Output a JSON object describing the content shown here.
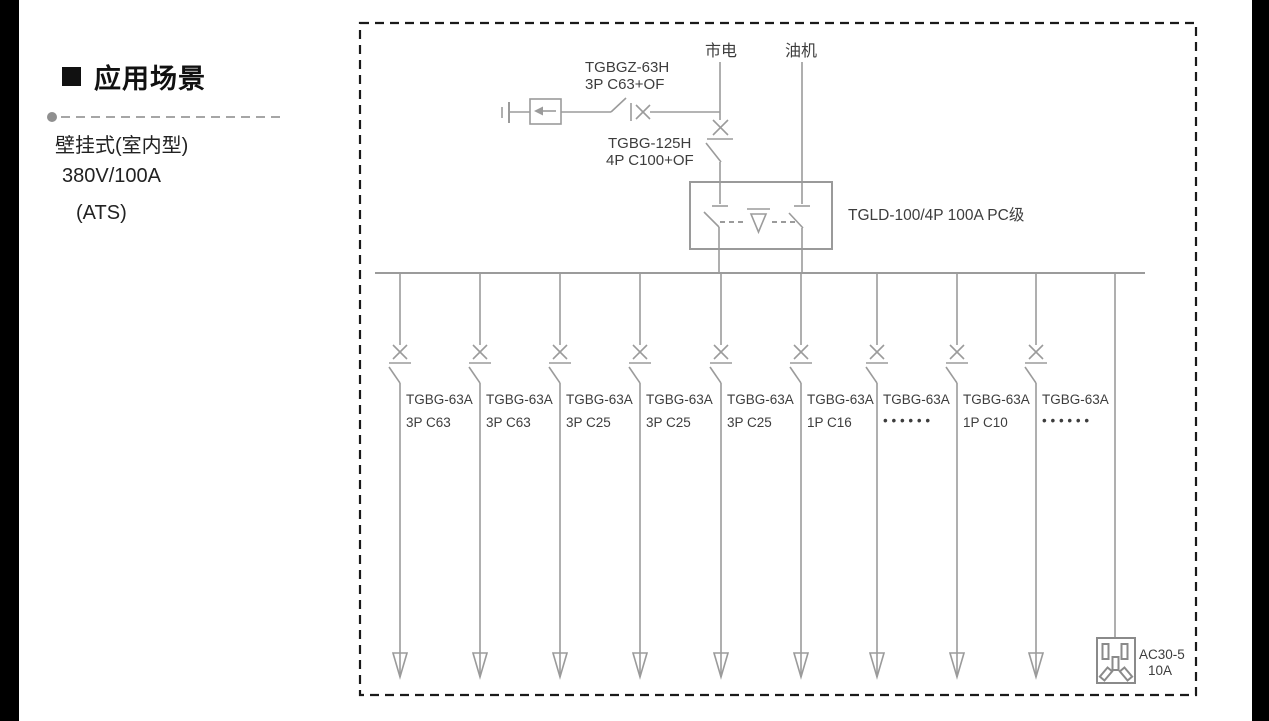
{
  "panel": {
    "heading": "应用场景",
    "lines": [
      "壁挂式(室内型)",
      "380V/100A",
      "(ATS)"
    ]
  },
  "diagram": {
    "sources": {
      "mains": "市电",
      "generator": "油机"
    },
    "surge_breaker": {
      "model": "TGBGZ-63H",
      "spec": "3P C63+OF"
    },
    "main_breaker": {
      "model": "TGBG-125H",
      "spec": "4P C100+OF"
    },
    "ats": {
      "label": "TGLD-100/4P 100A PC级"
    },
    "branches": [
      {
        "model": "TGBG-63A",
        "spec": "3P C63"
      },
      {
        "model": "TGBG-63A",
        "spec": "3P C63"
      },
      {
        "model": "TGBG-63A",
        "spec": "3P C25"
      },
      {
        "model": "TGBG-63A",
        "spec": "3P C25"
      },
      {
        "model": "TGBG-63A",
        "spec": "3P C25"
      },
      {
        "model": "TGBG-63A",
        "spec": "1P C16"
      },
      {
        "model": "TGBG-63A",
        "spec": "• • • • • •"
      },
      {
        "model": "TGBG-63A",
        "spec": "1P C10"
      },
      {
        "model": "TGBG-63A",
        "spec": "• • • • • •"
      }
    ],
    "socket": {
      "model": "AC30-5",
      "rating": "10A"
    },
    "colors": {
      "line": "#9b9b9b",
      "text": "#3d3d3d",
      "border": "#1a1a1a"
    }
  }
}
